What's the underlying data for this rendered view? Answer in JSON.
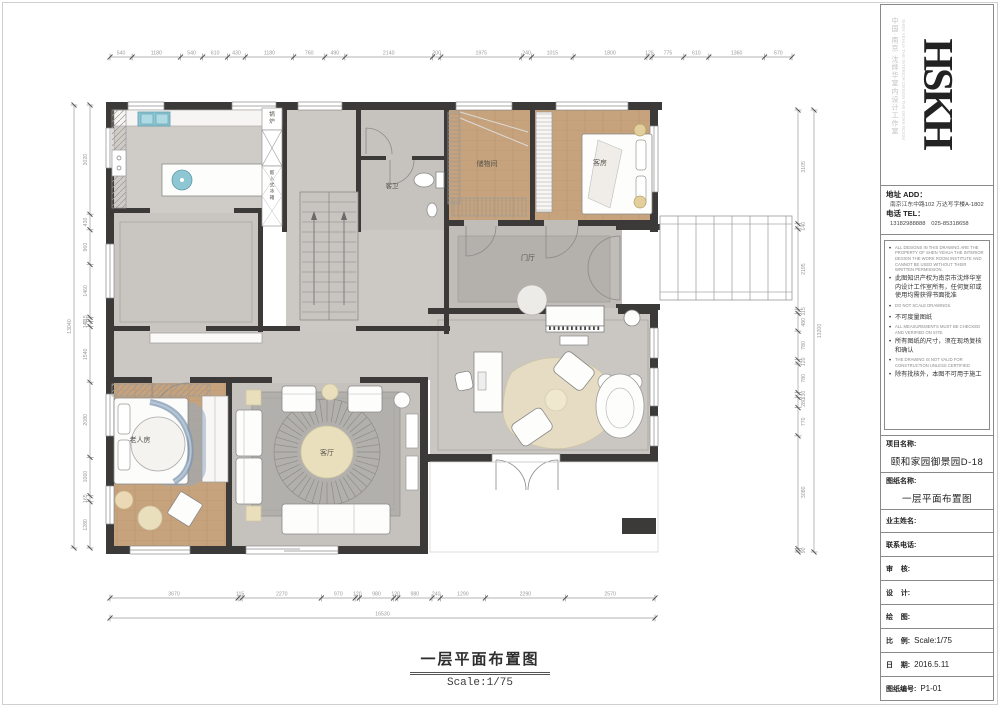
{
  "page": {
    "caption_title": "一层平面布置图",
    "caption_scale": "Scale:1/75"
  },
  "rooms": {
    "boiler": "锅炉",
    "fridge": "嵌入式冰箱",
    "guest_bath": "客卫",
    "storage": "储物间",
    "guest_room": "客房",
    "foyer": "门厅",
    "elder_room": "老人房",
    "living_room": "客厅"
  },
  "dimensions": {
    "top": [
      540,
      1180,
      540,
      610,
      430,
      1180,
      760,
      490,
      2140,
      200,
      1975,
      240,
      1015,
      1800,
      125,
      775,
      610,
      1360,
      670
    ],
    "bottom": [
      3670,
      115,
      2270,
      970,
      120,
      980,
      120,
      980,
      240,
      1290,
      2290,
      2570
    ],
    "bottom_total": [
      16530
    ],
    "left": [
      3020,
      430,
      960,
      1460,
      115,
      140,
      1540,
      2080,
      1060,
      165,
      1280
    ],
    "left_total": [
      13040
    ],
    "right": [
      3105,
      140,
      2195,
      115,
      480,
      780,
      120,
      780,
      130,
      280,
      770,
      3080,
      90
    ],
    "right_total": [
      13200
    ]
  },
  "titleblock": {
    "logo_text": "HSKH",
    "logo_side_cn": "中国·南京 沈烨华室内设计工作室",
    "logo_side_en": "SHEN YEHUA THE INTERIOR DESIGN THE WORK ROOM",
    "address_label": "地址 ADD：",
    "address_value": "南京江东中路102 万达写字楼A-1802",
    "phone_label": "电话 TEL：",
    "phone_value": "13182988888　025-85318658",
    "notes": [
      {
        "lang": "en",
        "text": "ALL DESIGNS IN THIS DRAWING ARE THE PROPERTY OF SHEN YEHUA THE INTERIOR DESIGN THE WORK ROOM INSTITUTE AND CANNOT BE USED WITHOUT THEIR WRITTEN PERMISSION."
      },
      {
        "lang": "cn",
        "text": "此图知识产权为南京市沈烨华室内设计工作室所有，任何复印或使用均需获得书面批准"
      },
      {
        "lang": "en",
        "text": "DO NOT SCALE DRAWINGS."
      },
      {
        "lang": "cn",
        "text": "不可度量图纸"
      },
      {
        "lang": "en",
        "text": "ALL MEASUREMENTS MUST BE CHECKED AND VERIFIED ON SITE."
      },
      {
        "lang": "cn",
        "text": "所有图纸的尺寸，须在现场复核和确认"
      },
      {
        "lang": "en",
        "text": "THE DRAWING IS NOT VALID FOR CONSTRUCTION UNLESS CERTIFIED"
      },
      {
        "lang": "cn",
        "text": "除有批核外，本图不可用于施工"
      }
    ],
    "fields": [
      {
        "label": "项目名称:",
        "value": "颐和家园御景园D-18"
      },
      {
        "label": "图纸名称:",
        "value": "一层平面布置图"
      },
      {
        "label": "业主姓名:",
        "value": ""
      },
      {
        "label": "联系电话:",
        "value": ""
      },
      {
        "label": "审    核:",
        "value": ""
      },
      {
        "label": "设    计:",
        "value": ""
      },
      {
        "label": "绘    图:",
        "value": ""
      },
      {
        "label": "比    例:",
        "value": "Scale:1/75"
      },
      {
        "label": "日    期:",
        "value": "2016.5.11"
      },
      {
        "label": "图纸编号:",
        "value": "P1-01"
      }
    ]
  }
}
